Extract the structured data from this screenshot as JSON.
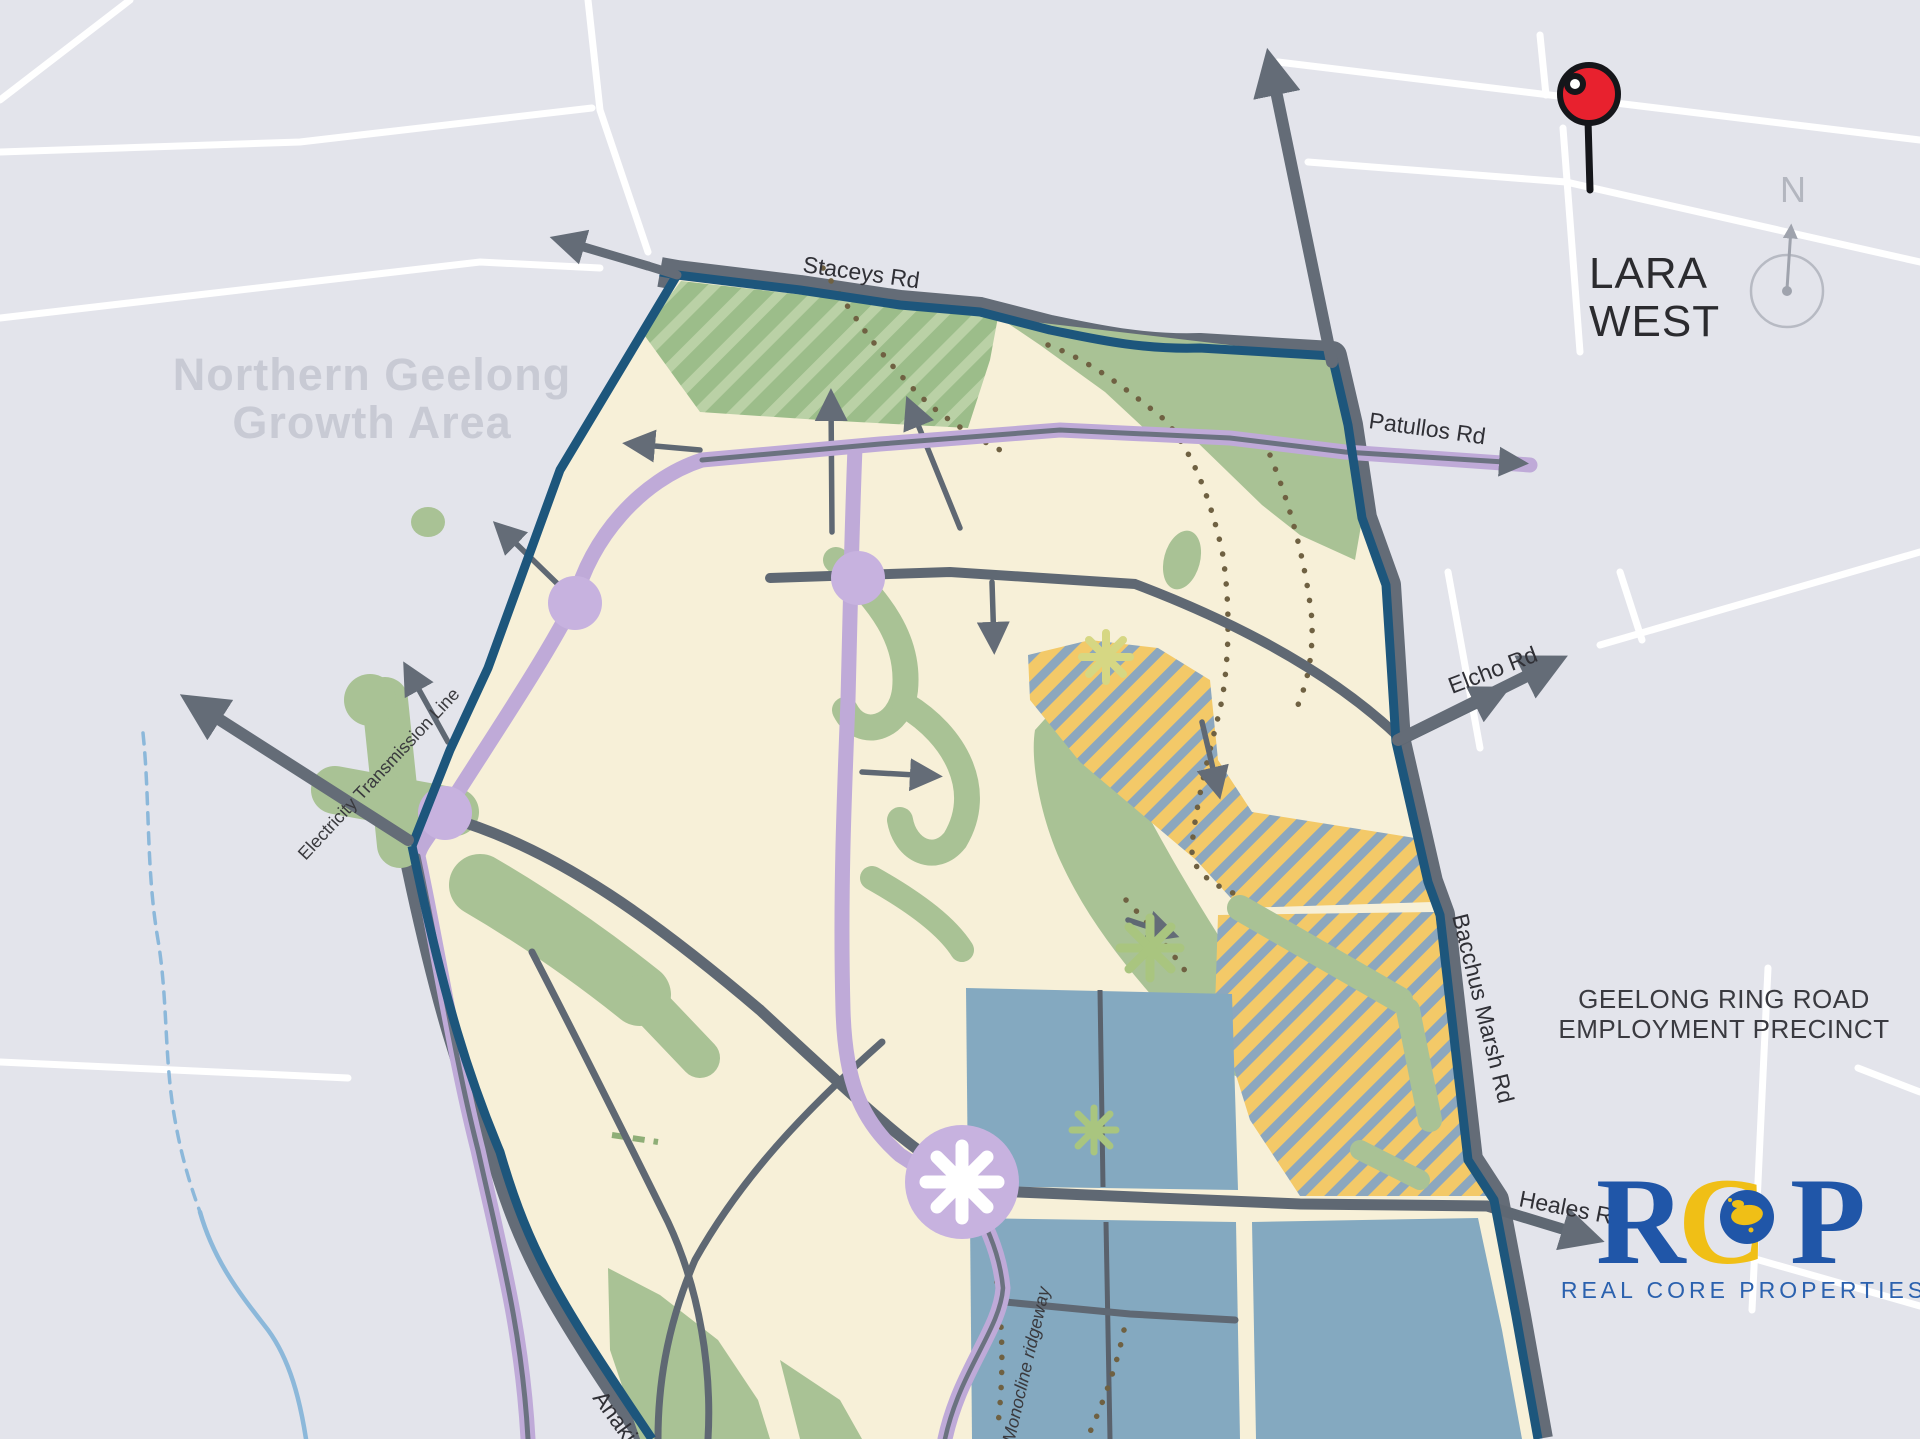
{
  "region": {
    "growth_area_line1": "Northern Geelong",
    "growth_area_line2": "Growth Area",
    "employment_line1": "GEELONG RING ROAD",
    "employment_line2": "EMPLOYMENT PRECINCT"
  },
  "title": {
    "line1": "LARA",
    "line2": "WEST"
  },
  "roads": {
    "staceys": "Staceys Rd",
    "patullos": "Patullos Rd",
    "elcho": "Elcho Rd",
    "bacchus_marsh": "Bacchus Marsh Rd",
    "heales": "Heales Rd",
    "anakie": "Anakie Rd"
  },
  "annotations": {
    "transmission_line": "Electricity  Transmission Line",
    "monocline": "Monocline  ridgeway"
  },
  "compass": {
    "north_label": "N"
  },
  "logo": {
    "letter_r": "R",
    "letter_c": "C",
    "letter_p": "P",
    "tagline": "REAL CORE PROPERTIES"
  },
  "colors": {
    "background": "#e3e4eb",
    "white_road": "#ffffff",
    "precinct_cream": "#f7f0d8",
    "green": "#a9c295",
    "green_hatch_light": "#bad1a6",
    "green_hatch_dark": "#9cbd8a",
    "boundary_navy": "#1d567c",
    "road_gray": "#646c77",
    "purple_road": "#bfaad8",
    "purple_node": "#c7b2df",
    "hatch_yellow": "#f3c968",
    "hatch_blue": "#8ca7be",
    "blue_parcel": "#84a9c0",
    "pin_red": "#e8212e",
    "logo_blue": "#2056a8",
    "logo_gold": "#f0bf16",
    "creek_blue": "#8cb8da",
    "dot_brown": "#6f6142"
  }
}
